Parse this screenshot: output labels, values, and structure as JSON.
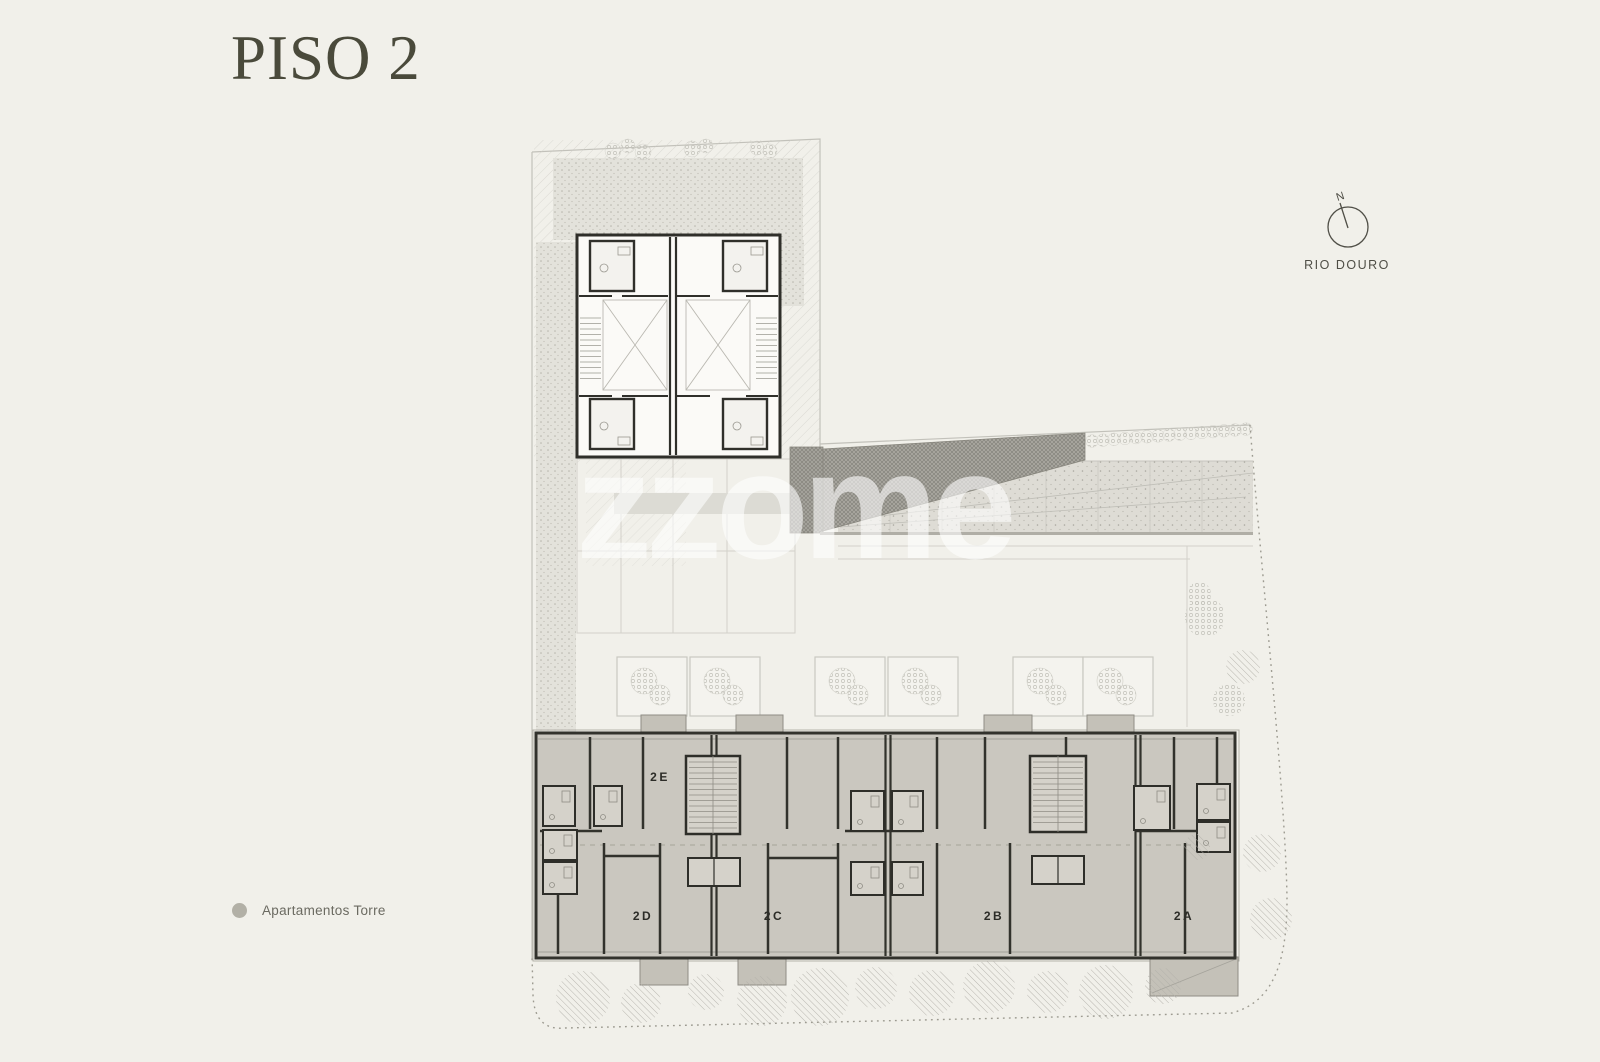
{
  "page": {
    "background_color": "#f1f0ea",
    "title": "PISO 2",
    "title_color": "#4a4a3b"
  },
  "compass": {
    "north_label": "N",
    "river_label": "RIO DOURO"
  },
  "watermark": {
    "text": "zzome"
  },
  "legend": {
    "items": [
      {
        "label": "Apartamentos Torre",
        "dot_color": "#b2b0a6"
      }
    ]
  },
  "floor_plan": {
    "floor_name": "PISO 2",
    "units": [
      {
        "id": "2E",
        "label": "2E"
      },
      {
        "id": "2D",
        "label": "2D"
      },
      {
        "id": "2C",
        "label": "2C"
      },
      {
        "id": "2B",
        "label": "2B"
      },
      {
        "id": "2A",
        "label": "2A"
      }
    ],
    "colors": {
      "block_fill": "#cac7bf",
      "wall": "#32322c",
      "terrace_fill": "#dedcd5",
      "ramp_fill": "#a8a69f",
      "stipple_fill": "#e3e2db",
      "boundary": "#9c9a90"
    }
  }
}
